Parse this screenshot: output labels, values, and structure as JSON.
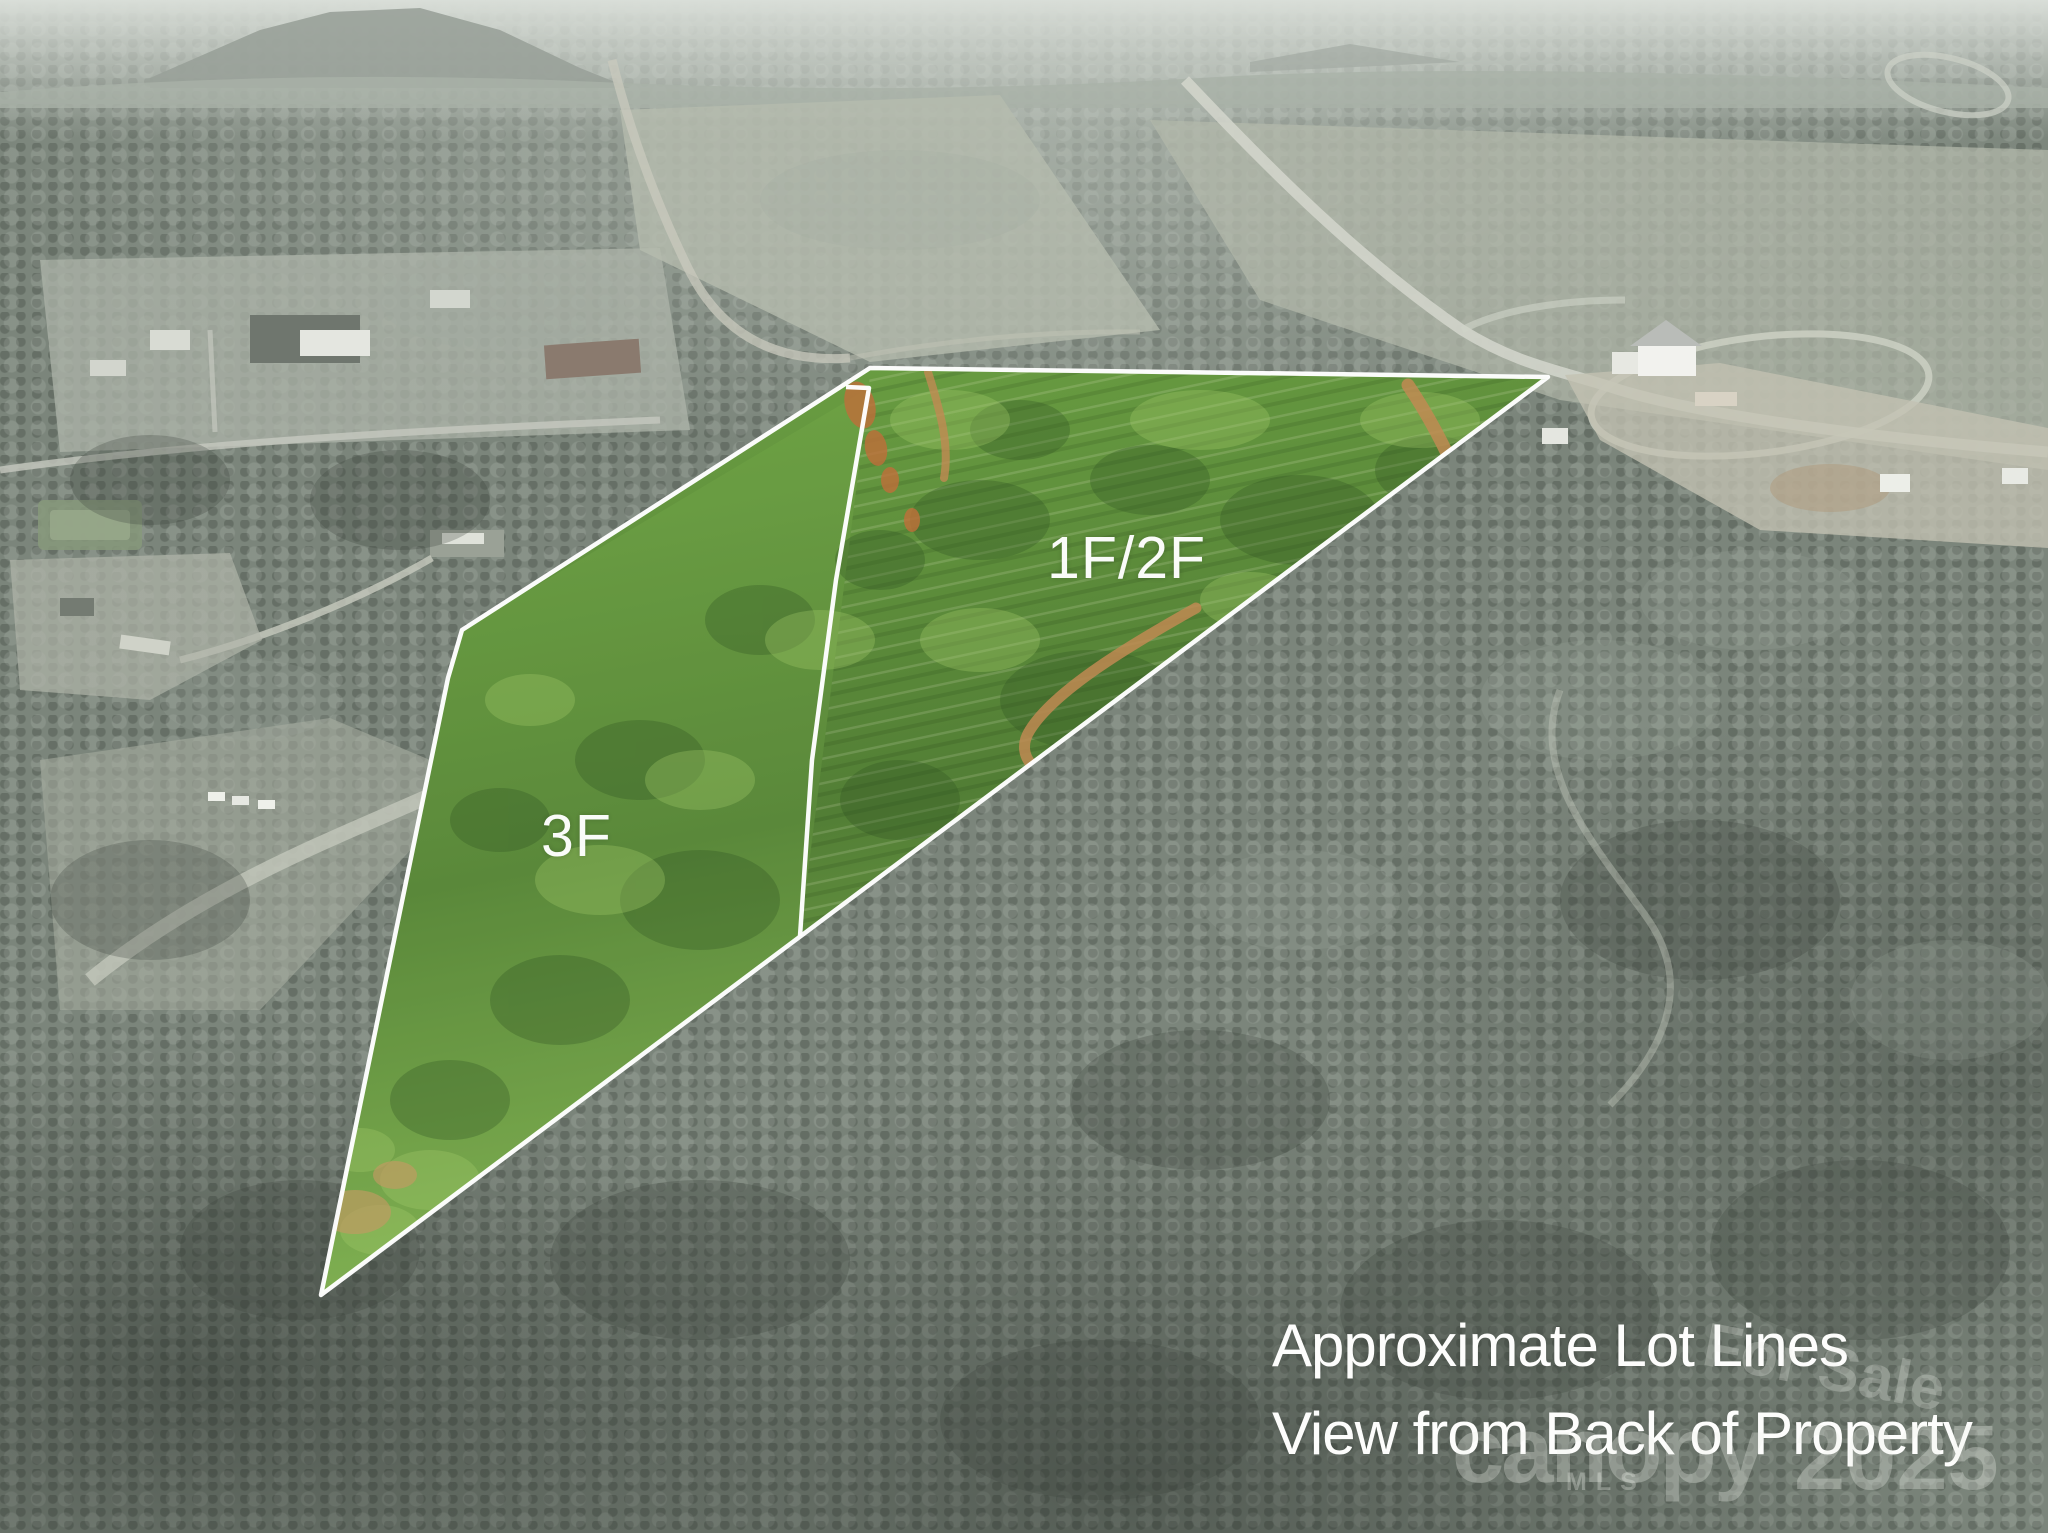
{
  "photo": {
    "scene": "Aerial drone view of rural wooded land; property lots highlighted in green over a desaturated landscape",
    "lot_labels": [
      {
        "id": "lot-1f2f",
        "text": "1F/2F"
      },
      {
        "id": "lot-3f",
        "text": "3F"
      }
    ],
    "caption": {
      "line1": "Approximate Lot Lines",
      "line2": "View from Back of Property"
    },
    "watermarks": {
      "for_sale": "For Sale",
      "brand": "canopy",
      "brand_sub": "MLS",
      "year": "2025"
    },
    "lot_lines": {
      "stroke_color": "#ffffff",
      "outer_points": "870,368 1548,377 321,1295 448,678 462,630",
      "lot1_points": "870,368 1548,377 800,936 869,388",
      "lot3_points": "869,388 800,936 321,1295 448,678 462,630",
      "divider_points": "846,387 869,388 836,580 812,760 800,936"
    },
    "highlight_color": "#578239"
  }
}
